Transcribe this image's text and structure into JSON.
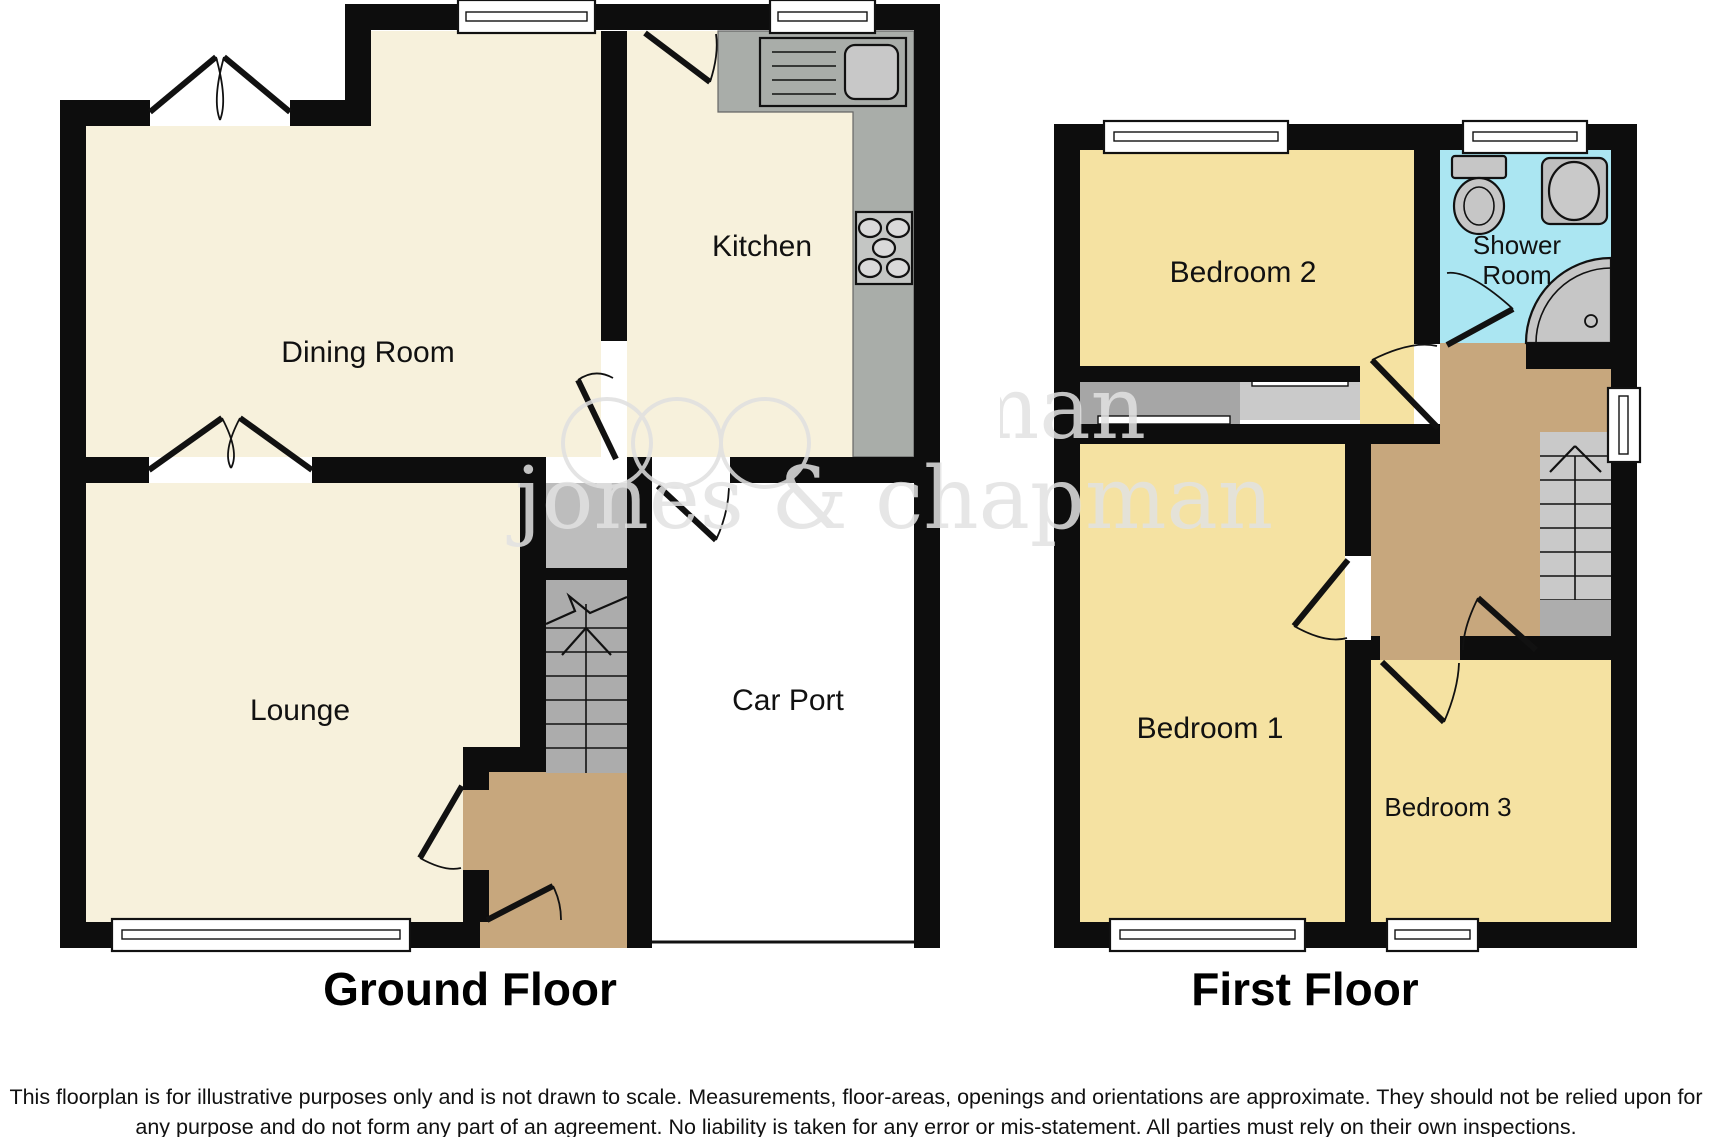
{
  "floorplan": {
    "watermark_text": "jones & chapman",
    "disclaimer": "This floorplan is for illustrative purposes only and is not drawn to scale. Measurements, floor-areas, openings and orientations are approximate. They should not be relied upon for any purpose and do not form any part of an agreement. No liability is taken for any error or mis-statement. All parties must rely on their own inspections.",
    "ground_floor": {
      "title": "Ground Floor",
      "rooms": {
        "dining_room": "Dining Room",
        "kitchen": "Kitchen",
        "lounge": "Lounge",
        "car_port": "Car Port"
      }
    },
    "first_floor": {
      "title": "First Floor",
      "rooms": {
        "bedroom_1": "Bedroom 1",
        "bedroom_2": "Bedroom 2",
        "bedroom_3": "Bedroom 3",
        "shower_room_line_1": "Shower",
        "shower_room_line_2": "Room"
      }
    },
    "colors": {
      "room_cream": "#F7F1DC",
      "room_yellow": "#F5E2A2",
      "hall_tan": "#C7A77D",
      "shower_blue": "#ABE6F2",
      "stairs_gray": "#ACACAC",
      "stairs_gray_light": "#C9C9C9",
      "stairs_platform": "#ADADAD",
      "counter_gray": "#A9ADA9",
      "cupboard_dark": "#A6A6A6",
      "cupboard_light": "#CACACA",
      "porch_gray": "#BDBDBD",
      "basin_gray": "#C8C8C8",
      "wall_black": "#0D0D0D",
      "watermark_gray": "#E2E2E2"
    }
  }
}
